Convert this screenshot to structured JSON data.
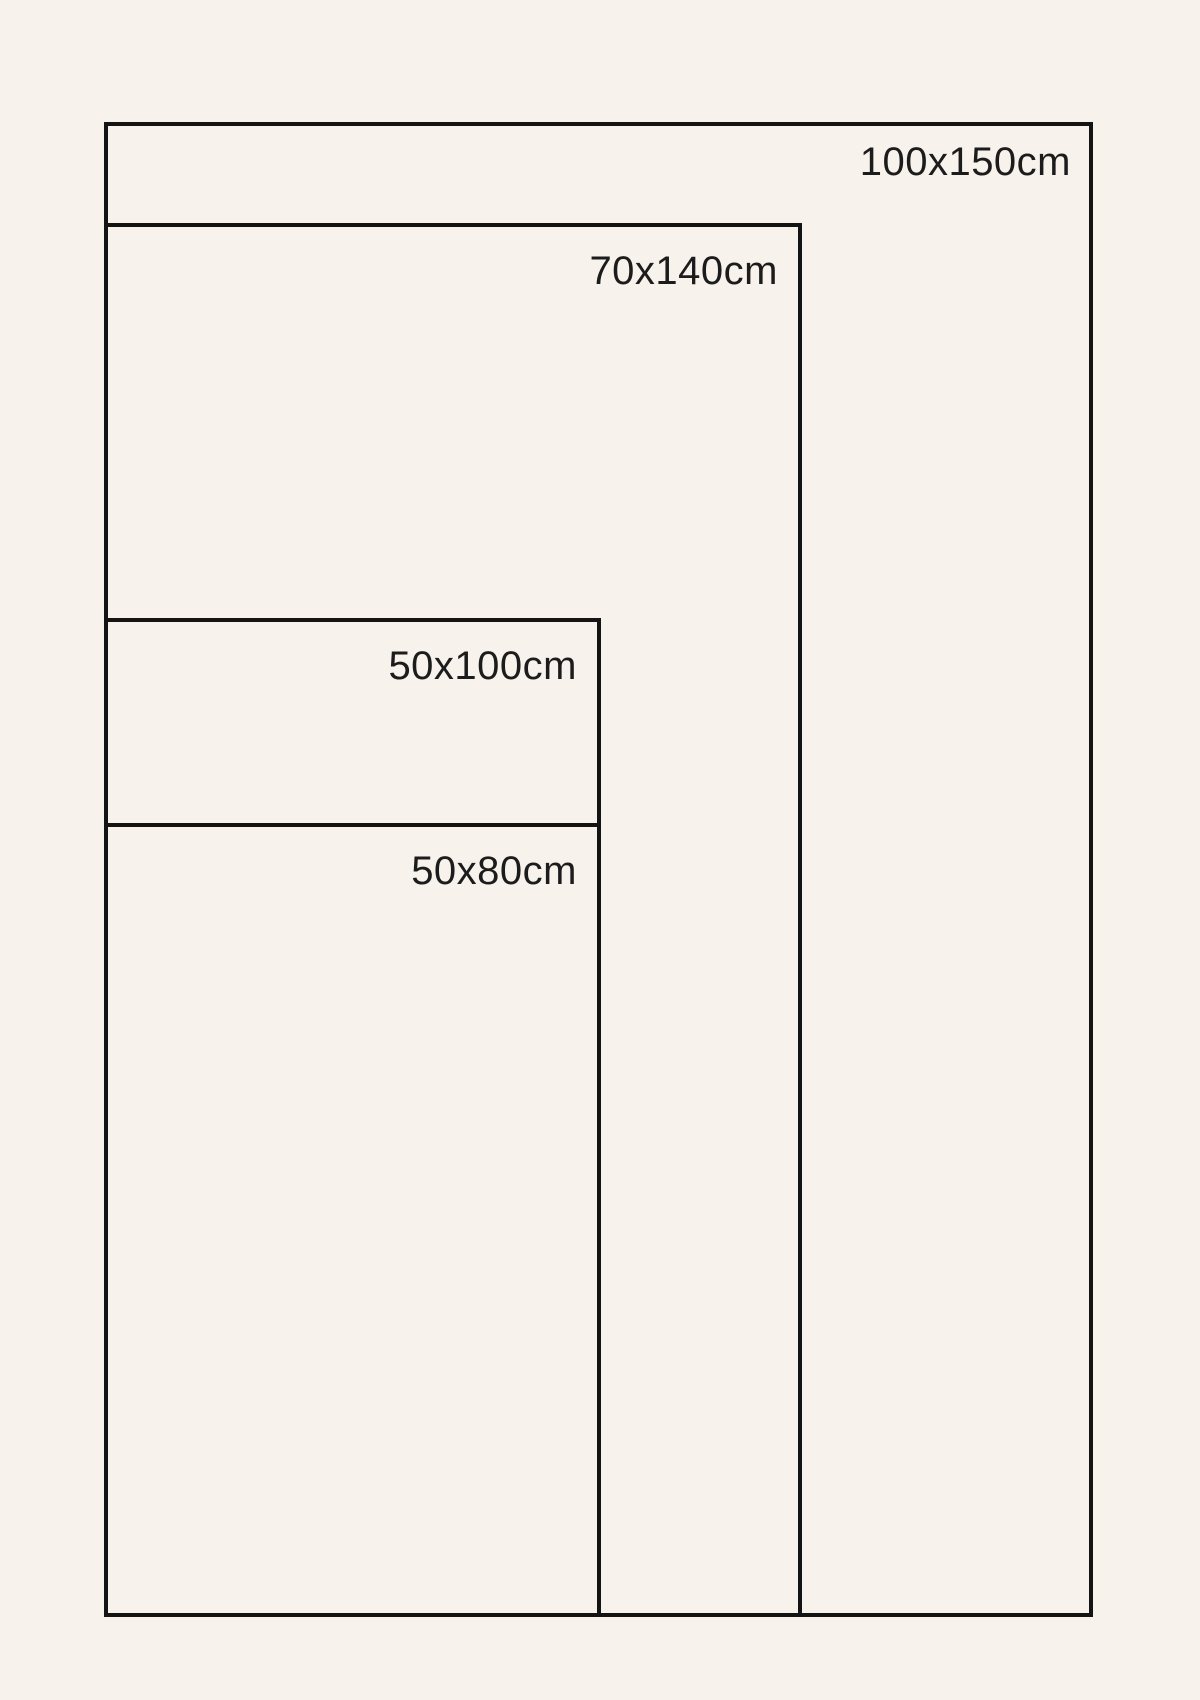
{
  "diagram": {
    "kind": "poster-size-comparison",
    "sizes": [
      {
        "label": "100x150cm",
        "width_cm": 100,
        "height_cm": 150
      },
      {
        "label": "70x140cm",
        "width_cm": 70,
        "height_cm": 140
      },
      {
        "label": "50x100cm",
        "width_cm": 50,
        "height_cm": 100
      },
      {
        "label": "50x80cm",
        "width_cm": 50,
        "height_cm": 80
      }
    ],
    "colors": {
      "background": "#f7f2ec",
      "line": "#141414",
      "text": "#1c1c1c"
    }
  }
}
